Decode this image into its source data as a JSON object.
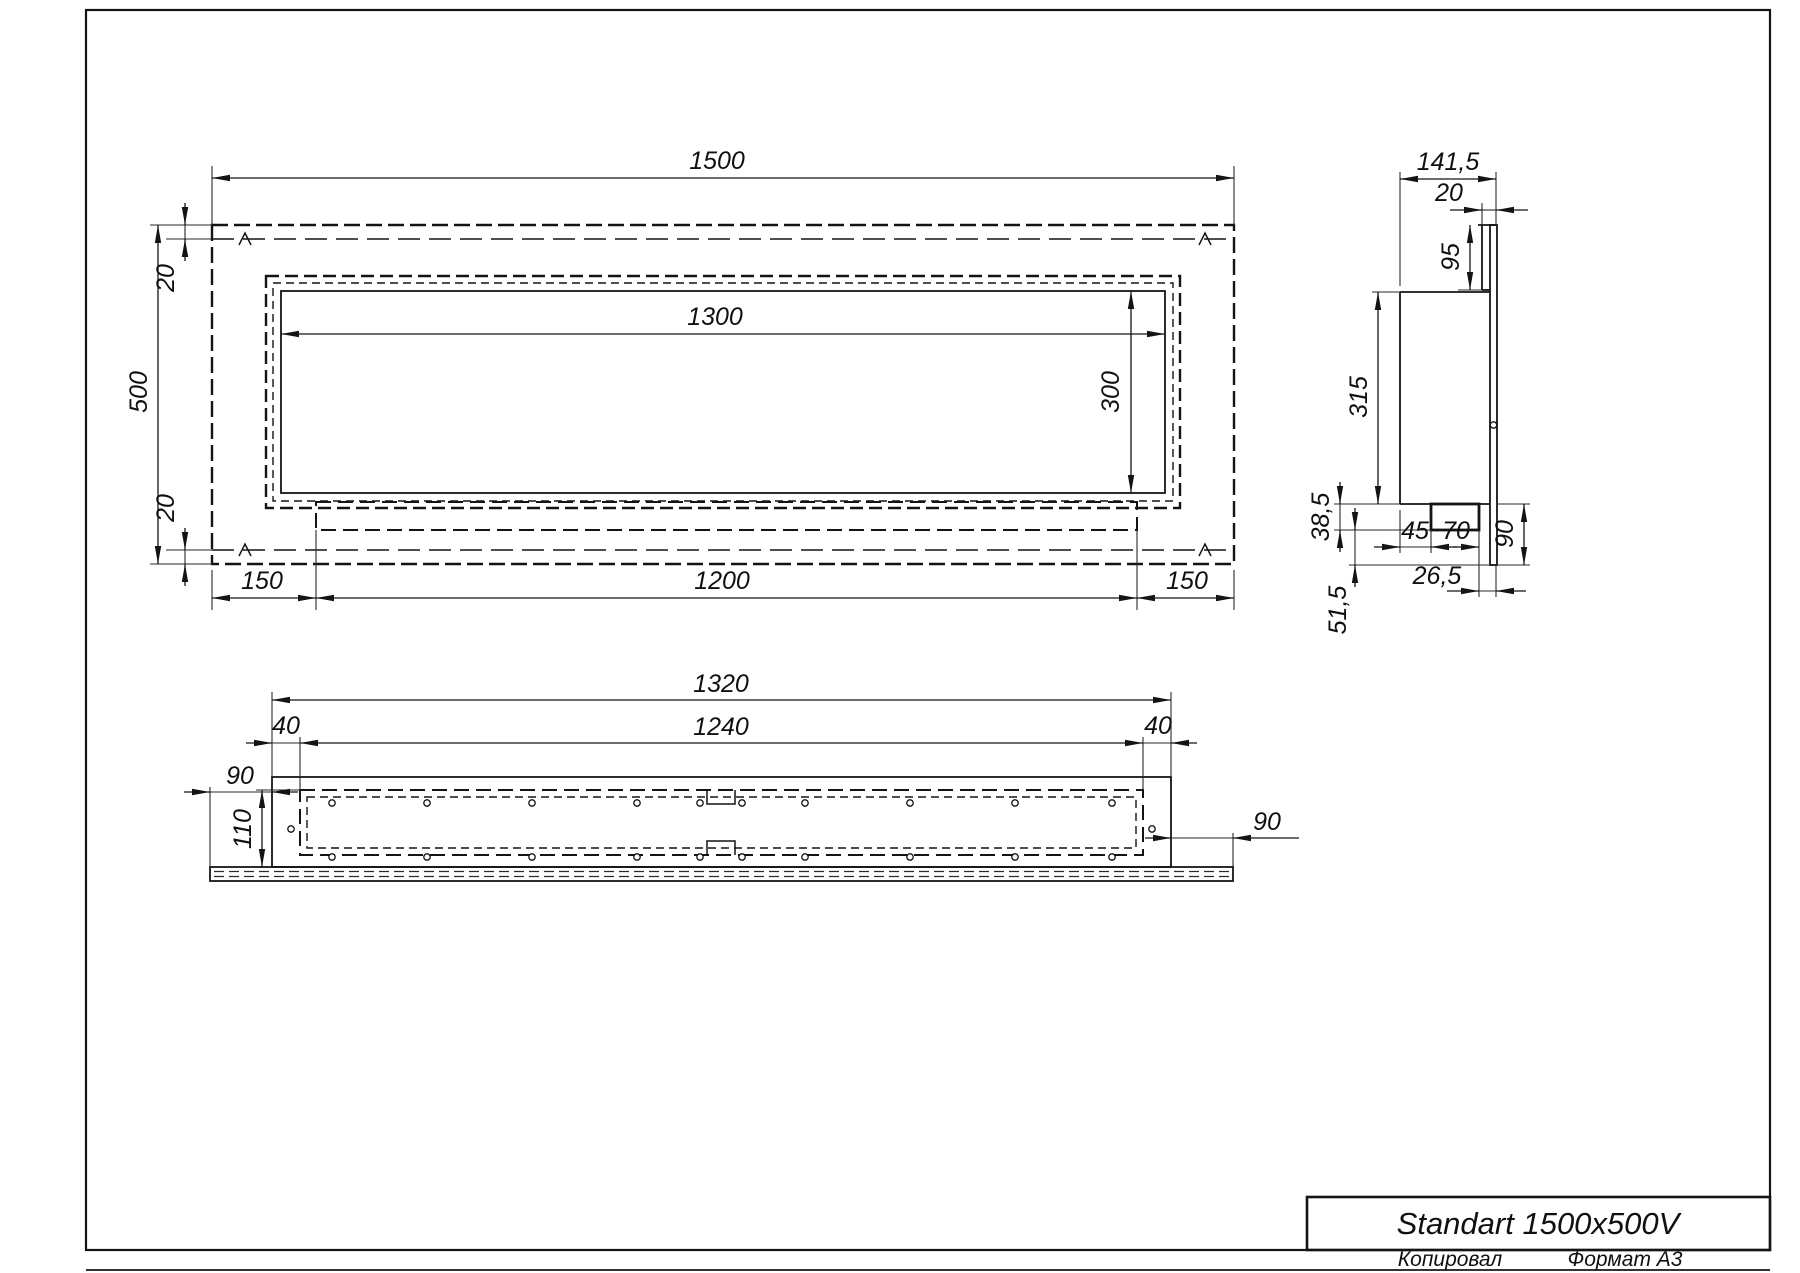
{
  "title_block": {
    "title": "Standart 1500x500V"
  },
  "footer": {
    "copied_by": "Копировал",
    "format": "Формат А3"
  },
  "front_view": {
    "width": "1500",
    "height": "500",
    "top_inset": "20",
    "bottom_inset": "20",
    "opening_width": "1300",
    "opening_height": "300",
    "left_margin": "150",
    "burner_width": "1200",
    "right_margin": "150"
  },
  "side_view": {
    "depth": "141,5",
    "flange_depth": "20",
    "flange_height": "95",
    "body_height": "315",
    "tray_height": "38,5",
    "tray_offset": "45",
    "tray_width": "70",
    "plate_extension": "90",
    "rear_offset": "26,5",
    "bottom_offset": "51,5"
  },
  "bottom_view": {
    "body_length": "1320",
    "inner_length": "1240",
    "left_end": "40",
    "right_end": "40",
    "left_overhang": "90",
    "depth": "110",
    "right_overhang": "90"
  }
}
